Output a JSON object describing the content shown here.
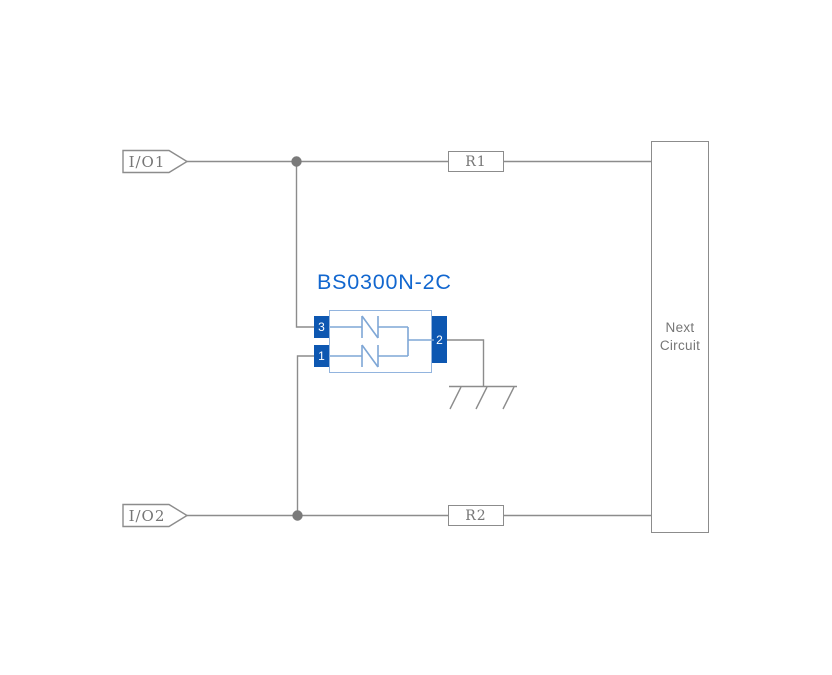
{
  "connectors": {
    "io1": "I/O1",
    "io2": "I/O2"
  },
  "resistors": {
    "r1": "R1",
    "r2": "R2"
  },
  "component": {
    "label": "BS0300N-2C",
    "pins": {
      "pin1": "1",
      "pin2": "2",
      "pin3": "3"
    }
  },
  "next_circuit": {
    "line1": "Next",
    "line2": "Circuit"
  },
  "icons": {
    "ground": "ground-icon",
    "junction_top": "junction-dot",
    "junction_bottom": "junction-dot",
    "tvs_diode_top": "tvs-diode-icon",
    "tvs_diode_bottom": "tvs-diode-icon",
    "io_tag": "connector-tag-arrow"
  },
  "colors": {
    "background": "#ffffff",
    "wire_gray": "#8c8c8c",
    "junction_gray": "#7a7a7a",
    "text_gray": "#767676",
    "pin_blue": "#0d57b1",
    "component_label_blue": "#1267cf",
    "component_outline_blue": "#92b4de",
    "diode_symbol_blue": "#7fa7d6"
  }
}
